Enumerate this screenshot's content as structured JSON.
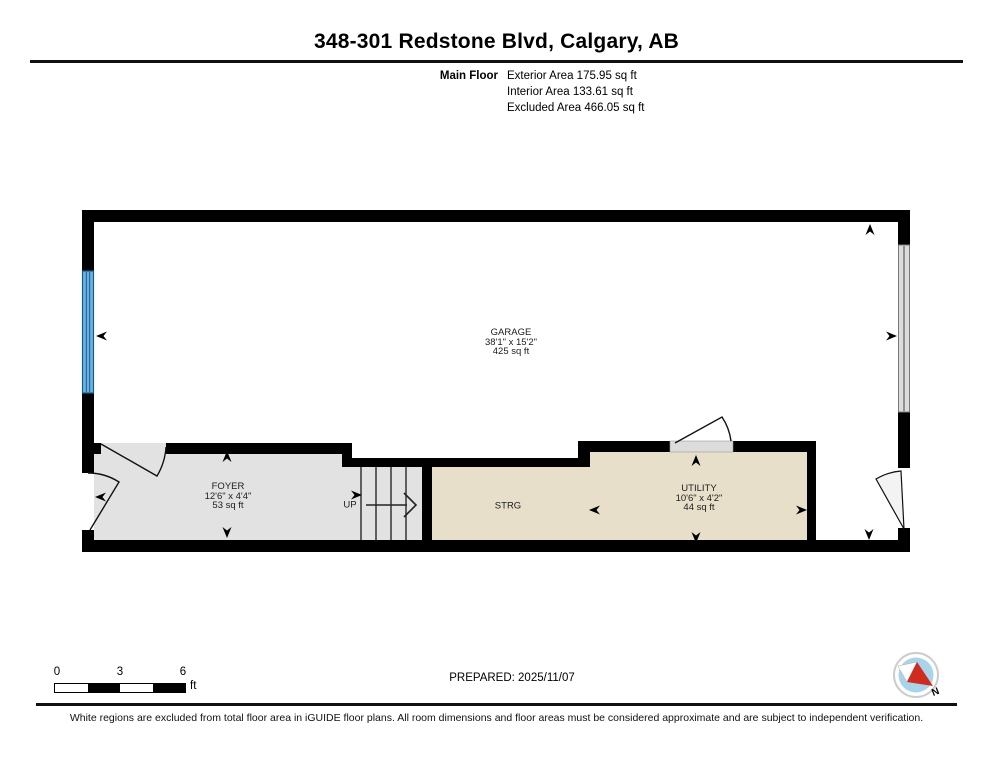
{
  "header": {
    "title": "348-301 Redstone Blvd, Calgary, AB",
    "floor_label": "Main Floor",
    "stats": [
      "Exterior Area 175.95 sq ft",
      "Interior Area 133.61 sq ft",
      "Excluded Area 466.05 sq ft"
    ]
  },
  "rooms": {
    "garage": {
      "name": "GARAGE",
      "dims": "38'1\" x 15'2\"",
      "area": "425 sq ft"
    },
    "foyer": {
      "name": "FOYER",
      "dims": "12'6\" x 4'4\"",
      "area": "53 sq ft"
    },
    "storage": {
      "name": "STRG"
    },
    "utility": {
      "name": "UTILITY",
      "dims": "10'6\" x 4'2\"",
      "area": "44 sq ft"
    }
  },
  "stairs": {
    "up_label": "UP"
  },
  "scale_bar": {
    "ticks": [
      "0",
      "3",
      "6"
    ],
    "unit": "ft"
  },
  "compass": {
    "north_label": "N"
  },
  "footer": {
    "prepared": "PREPARED: 2025/11/07",
    "disclaimer": "White regions are excluded from total floor area in iGUIDE floor plans. All room dimensions and floor areas must be considered approximate and are subject to independent verification."
  },
  "colors": {
    "wall": "#000000",
    "floor_gray": "#e2e2e2",
    "floor_beige": "#e7dfca",
    "window_blue": "#69b4e0",
    "door_gray": "#dcdcdc",
    "compass_blue": "#a9d4ea",
    "compass_red": "#cf2b1e"
  }
}
